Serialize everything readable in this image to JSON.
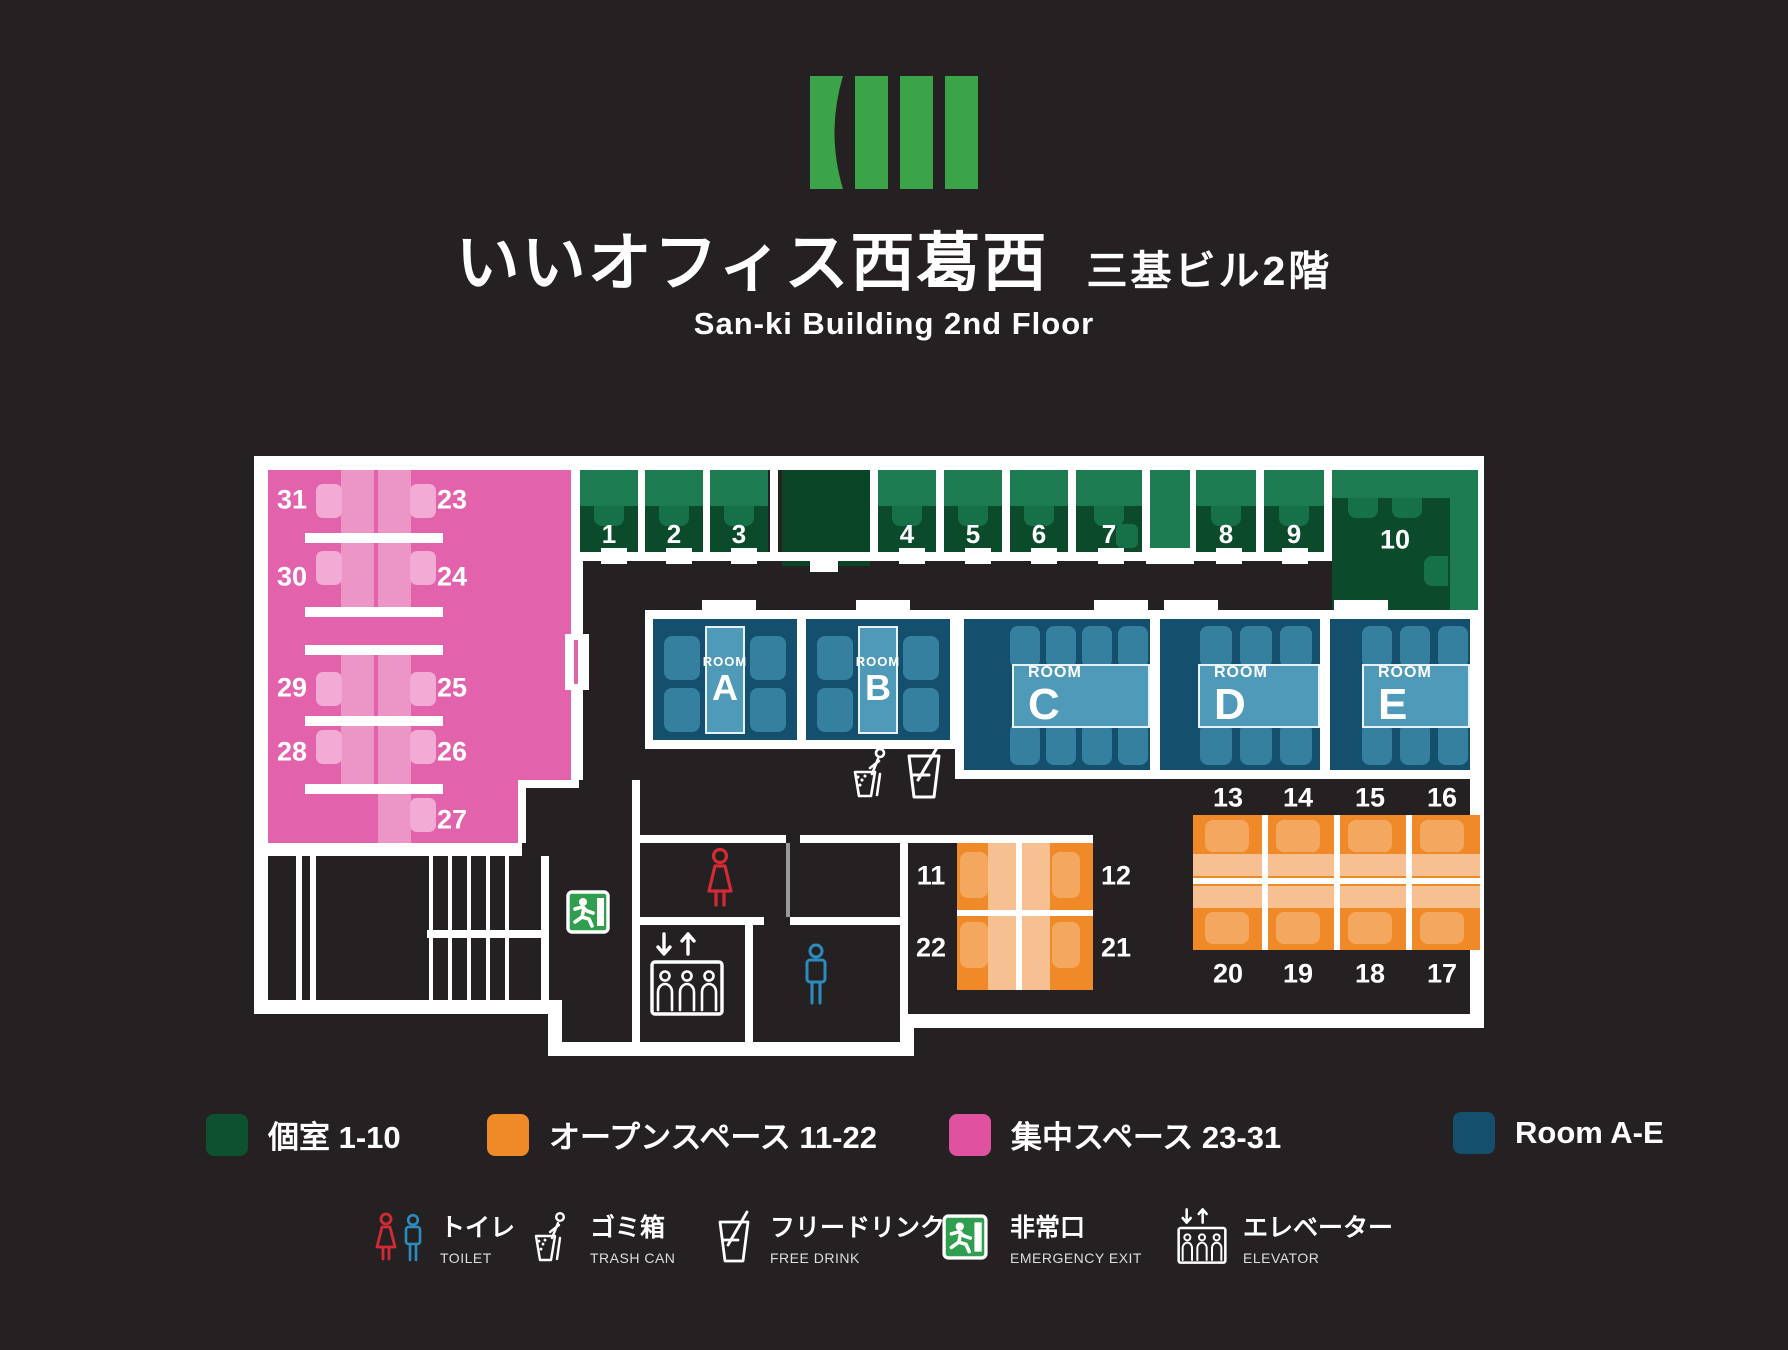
{
  "header": {
    "title": "いいオフィス西葛西",
    "annex": "三基ビル2階",
    "subtitle": "San-ki Building 2nd Floor"
  },
  "plan": {
    "booths": [
      "1",
      "2",
      "3",
      "4",
      "5",
      "6",
      "7",
      "8",
      "9",
      "10"
    ],
    "room_word": "ROOM",
    "room_letters": [
      "A",
      "B",
      "C",
      "D",
      "E"
    ],
    "focus_numbers": [
      "31",
      "23",
      "30",
      "24",
      "29",
      "25",
      "28",
      "26",
      "27"
    ],
    "open_small": [
      "11",
      "12",
      "22",
      "21"
    ],
    "open_large_top": [
      "13",
      "14",
      "15",
      "16"
    ],
    "open_large_bottom": [
      "20",
      "19",
      "18",
      "17"
    ]
  },
  "legend": {
    "zones": [
      {
        "label": "個室 1-10",
        "color": "#0d5130"
      },
      {
        "label": "オープンスペース 11-22",
        "color": "#f08a29"
      },
      {
        "label": "集中スペース 23-31",
        "color": "#e0519f"
      },
      {
        "label": "Room A-E",
        "color": "#14506e"
      }
    ],
    "facilities": [
      {
        "icon": "toilet-icon",
        "jp": "トイレ",
        "en": "TOILET"
      },
      {
        "icon": "trash-icon",
        "jp": "ゴミ箱",
        "en": "TRASH CAN"
      },
      {
        "icon": "drink-icon",
        "jp": "フリードリンク",
        "en": "FREE DRINK"
      },
      {
        "icon": "exit-icon",
        "jp": "非常口",
        "en": "EMERGENCY EXIT"
      },
      {
        "icon": "elevator-icon",
        "jp": "エレベーター",
        "en": "ELEVATOR"
      }
    ]
  },
  "colors": {
    "background": "#252122",
    "wall": "#ffffff",
    "logo_green": "#3ba449",
    "booth_dark_green": "#0b4a2b",
    "booth_light_green": "#1c7b51",
    "focus_pink": "#e263ac",
    "open_orange": "#f08a29",
    "room_blue": "#14506e",
    "room_table_blue": "#4e9ab8",
    "toilet_female_red": "#d32b35",
    "toilet_male_blue": "#2b8cbe",
    "exit_green": "#2f9e4f"
  }
}
